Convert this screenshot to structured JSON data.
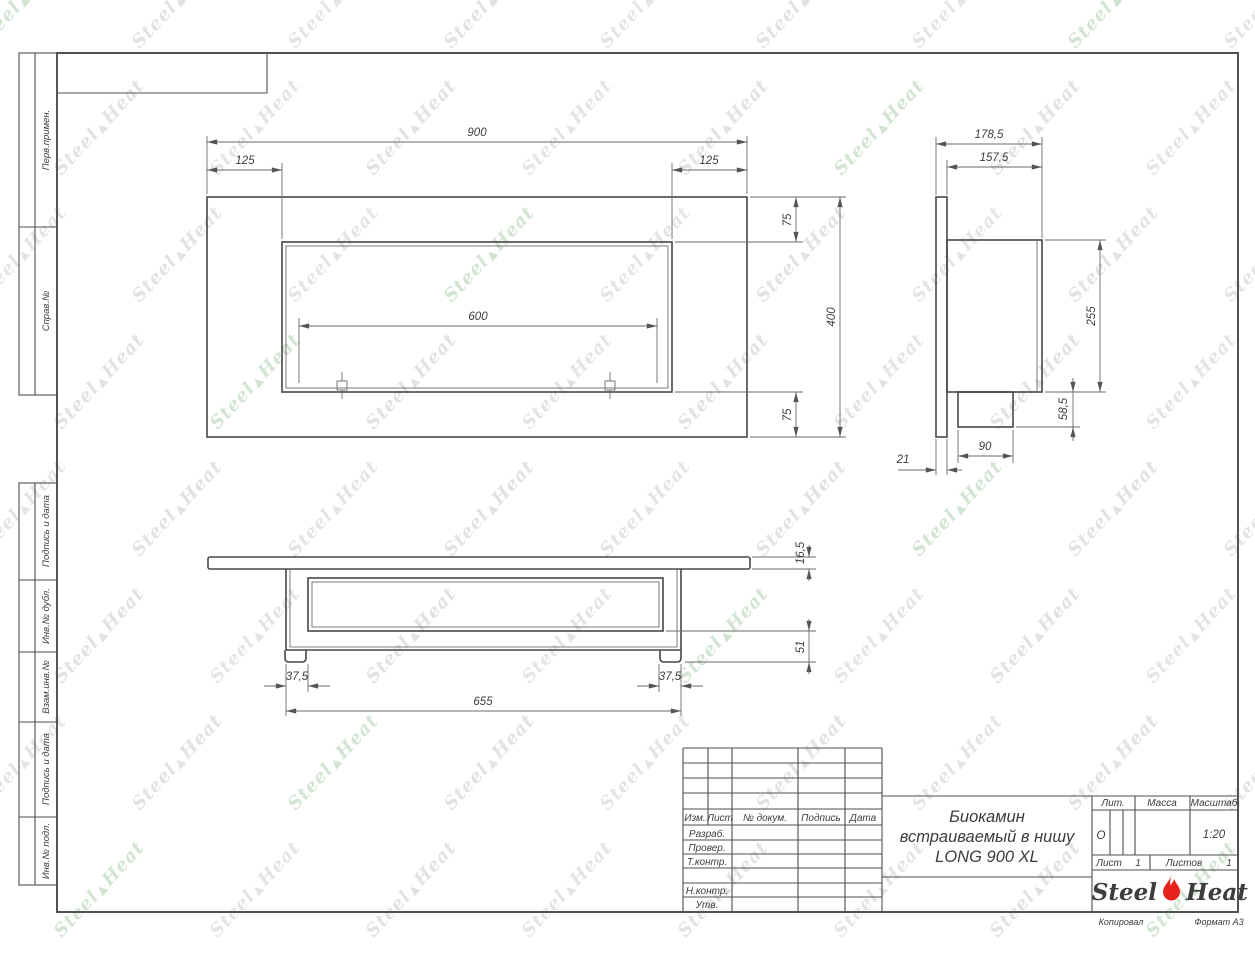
{
  "drawing": {
    "title_lines": [
      "Биокамин",
      "встраиваемый в нишу",
      "LONG 900 XL"
    ],
    "dims": {
      "front": {
        "total": "900",
        "left": "125",
        "right": "125",
        "slot": "600",
        "top": "75",
        "height": "400",
        "bottom": "75"
      },
      "side": {
        "total_depth": "178,5",
        "body_depth": "157,5",
        "body_height": "255",
        "spout_height": "58,5",
        "spout_width": "90",
        "panel_thickness": "21"
      },
      "bottom": {
        "plate_thickness": "16,5",
        "lower_height": "51",
        "left_offset": "37,5",
        "right_offset": "37,5",
        "base_width": "655"
      }
    }
  },
  "margin_labels": {
    "perv": "Перв.примен.",
    "sprav": "Справ.№",
    "podpis1": "Подпись и дата",
    "inv_dubl": "Инв.№ дубл.",
    "vzam": "Взам.инв.№",
    "podpis2": "Подпись и дата",
    "inv_podl": "Инв.№ подл."
  },
  "title_block": {
    "col_izm": "Изм.",
    "col_list": "Лист",
    "col_docnum": "№ докум.",
    "col_podpis": "Подпись",
    "col_data": "Дата",
    "row_razrab": "Разраб.",
    "row_prover": "Провер.",
    "row_tkontr": "Т.контр.",
    "row_nkontr": "Н.контр.",
    "row_utv": "Утв.",
    "lit_label": "Лит.",
    "lit_value": "О",
    "mass_label": "Масса",
    "scale_label": "Масштаб",
    "scale_value": "1:20",
    "sheet_label": "Лист",
    "sheet_value": "1",
    "sheets_label": "Листов",
    "sheets_value": "1",
    "footer_copy": "Копировал",
    "footer_format": "Формат А3"
  },
  "logo": {
    "steel": "Steel",
    "heat": "Heat",
    "flame_color": "#e8231e"
  },
  "watermark": {
    "steel": "Steel",
    "heat": "Heat",
    "colors": [
      "#ccd2cc",
      "#c5cec5",
      "#aecfae"
    ]
  }
}
